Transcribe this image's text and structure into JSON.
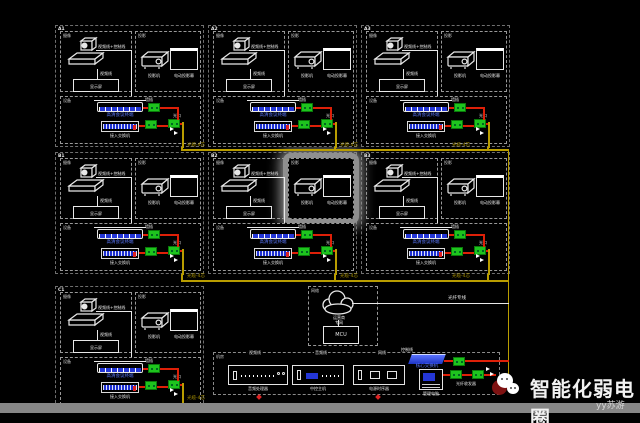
{
  "watermark": {
    "title": "智能化弱电圈",
    "author": "yy苏游",
    "icon": "wechat-bubbles-icon"
  },
  "rooms": [
    {
      "id": "A1"
    },
    {
      "id": "A2"
    },
    {
      "id": "A3"
    },
    {
      "id": "B1"
    },
    {
      "id": "B2",
      "highlighted": true
    },
    {
      "id": "B3"
    },
    {
      "id": "C1"
    }
  ],
  "room_shared": {
    "cam_tag": "摄像",
    "proj_tag": "投影",
    "eq_tag": "设备",
    "cam_wire_label": "视频线+控制线",
    "cam_drop_label": "视频线",
    "tv_label": "显示屏",
    "proj_label": "投影机",
    "screen_label": "电动投影幕",
    "codec_label": "高清会议终端",
    "switch_label": "接入交换机",
    "block1_label": "墙插",
    "block3_label": "光口"
  },
  "wires": {
    "fiber_drop_label": "光缆-4芯",
    "line_color_red": "#de2008",
    "line_color_fiber": "#b99d00"
  },
  "network": {
    "tag": "网络",
    "cloud_label_1": "运营商",
    "cloud_label_2": "专网",
    "mcu_label": "MCU",
    "line_label": "光纤专线"
  },
  "rack": {
    "tag": "机房",
    "cable_labels": [
      "视频线",
      "音频线",
      "网线",
      "控制线"
    ],
    "devices": [
      {
        "label": "音频处理器"
      },
      {
        "label": "中控主机"
      },
      {
        "label": "电源时序器"
      }
    ],
    "switch_label": "核心交换机",
    "pc_label": "管理电脑",
    "transceiver_label": "光纤收发器",
    "marks": [
      "1",
      "2"
    ]
  },
  "colors": {
    "background": "#000000",
    "panel_border": "#6f6f6f",
    "device_line": "#e8e8e8",
    "device_face_blue": "#2436d6",
    "terminal_green": "#1ec41e",
    "highlight_gray": "#8f8f8f",
    "bottom_bar_gray": "#868686"
  }
}
